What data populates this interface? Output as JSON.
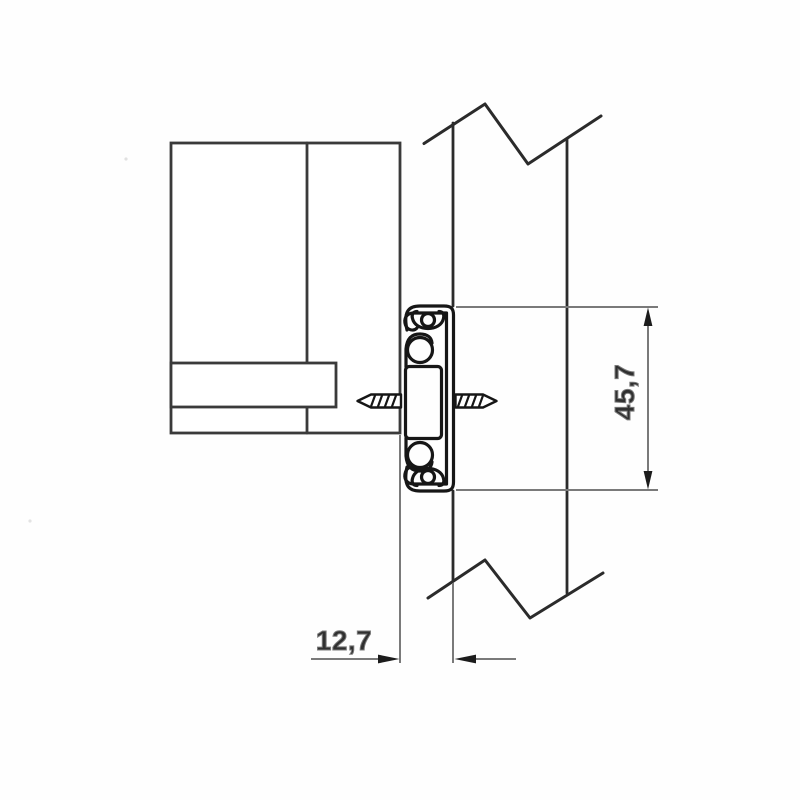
{
  "figure": {
    "kind": "technical-drawing",
    "subject": "drawer-slide-cross-section-mounting-diagram"
  },
  "dimensions": {
    "height": {
      "label": "45,7",
      "value": 45.7,
      "orientation": "vertical"
    },
    "thickness": {
      "label": "12,7",
      "value": 12.7,
      "orientation": "horizontal"
    }
  },
  "colors": {
    "background": "#fefefe",
    "object_line": "#3a3a3a",
    "panel_line": "#2b2b2b",
    "profile_line": "#161616",
    "dimension_line": "#7a7a7a",
    "arrow": "#1c1c1c",
    "label": "#303030"
  }
}
